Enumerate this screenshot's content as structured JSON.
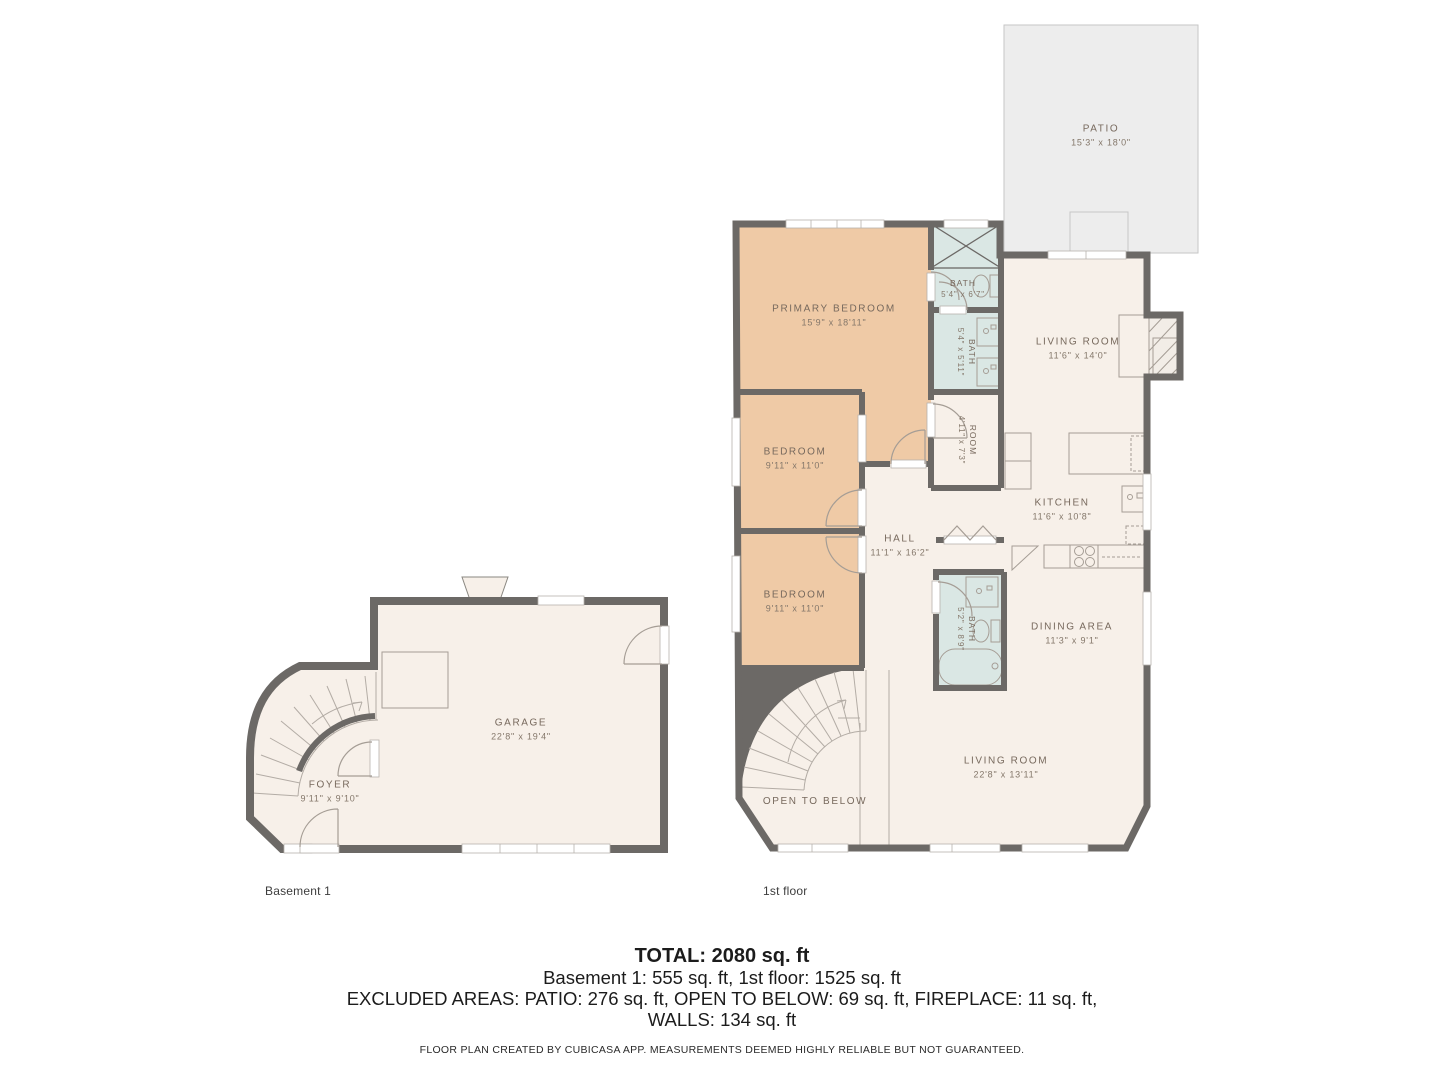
{
  "colors": {
    "wall": "#6c6966",
    "floor": "#f7f0e9",
    "bedroom_fill": "#efcaa6",
    "bath_fill": "#dae7e4",
    "patio_fill": "#ededed",
    "label_text": "#77695d"
  },
  "floors": {
    "first": {
      "caption": "1st floor",
      "rooms": {
        "patio": {
          "name": "PATIO",
          "dims": "15'3\" x 18'0\""
        },
        "primary_bedroom": {
          "name": "PRIMARY BEDROOM",
          "dims": "15'9\" x 18'11\""
        },
        "bath_top": {
          "name": "BATH",
          "dims": "5'4\" x 6'7\""
        },
        "bath_mid": {
          "name": "BATH",
          "dims": "5'4\" x 5'11\""
        },
        "living_room_upper": {
          "name": "LIVING ROOM",
          "dims": "11'6\" x 14'0\""
        },
        "room": {
          "name": "ROOM",
          "dims": "4'11\" x 7'3\""
        },
        "bedroom_mid": {
          "name": "BEDROOM",
          "dims": "9'11\" x 11'0\""
        },
        "kitchen": {
          "name": "KITCHEN",
          "dims": "11'6\" x 10'8\""
        },
        "hall": {
          "name": "HALL",
          "dims": "11'1\" x 16'2\""
        },
        "bedroom_low": {
          "name": "BEDROOM",
          "dims": "9'11\" x 11'0\""
        },
        "bath_low": {
          "name": "BATH",
          "dims": "5'2\" x 8'9\""
        },
        "dining": {
          "name": "DINING AREA",
          "dims": "11'3\" x 9'1\""
        },
        "living_room_lower": {
          "name": "LIVING ROOM",
          "dims": "22'8\" x 13'11\""
        },
        "open_to_below": {
          "name": "OPEN TO BELOW"
        }
      }
    },
    "basement": {
      "caption": "Basement 1",
      "rooms": {
        "garage": {
          "name": "GARAGE",
          "dims": "22'8\" x 19'4\""
        },
        "foyer": {
          "name": "FOYER",
          "dims": "9'11\" x 9'10\""
        }
      }
    }
  },
  "summary": {
    "total": "TOTAL: 2080 sq. ft",
    "floors_line": "Basement 1: 555 sq. ft, 1st floor: 1525 sq. ft",
    "excluded_line": "EXCLUDED AREAS: PATIO: 276 sq. ft, OPEN TO BELOW: 69 sq. ft, FIREPLACE: 11 sq. ft,",
    "walls_line": "WALLS: 134 sq. ft",
    "footnote": "FLOOR PLAN CREATED BY CUBICASA APP. MEASUREMENTS DEEMED HIGHLY RELIABLE BUT NOT GUARANTEED."
  }
}
